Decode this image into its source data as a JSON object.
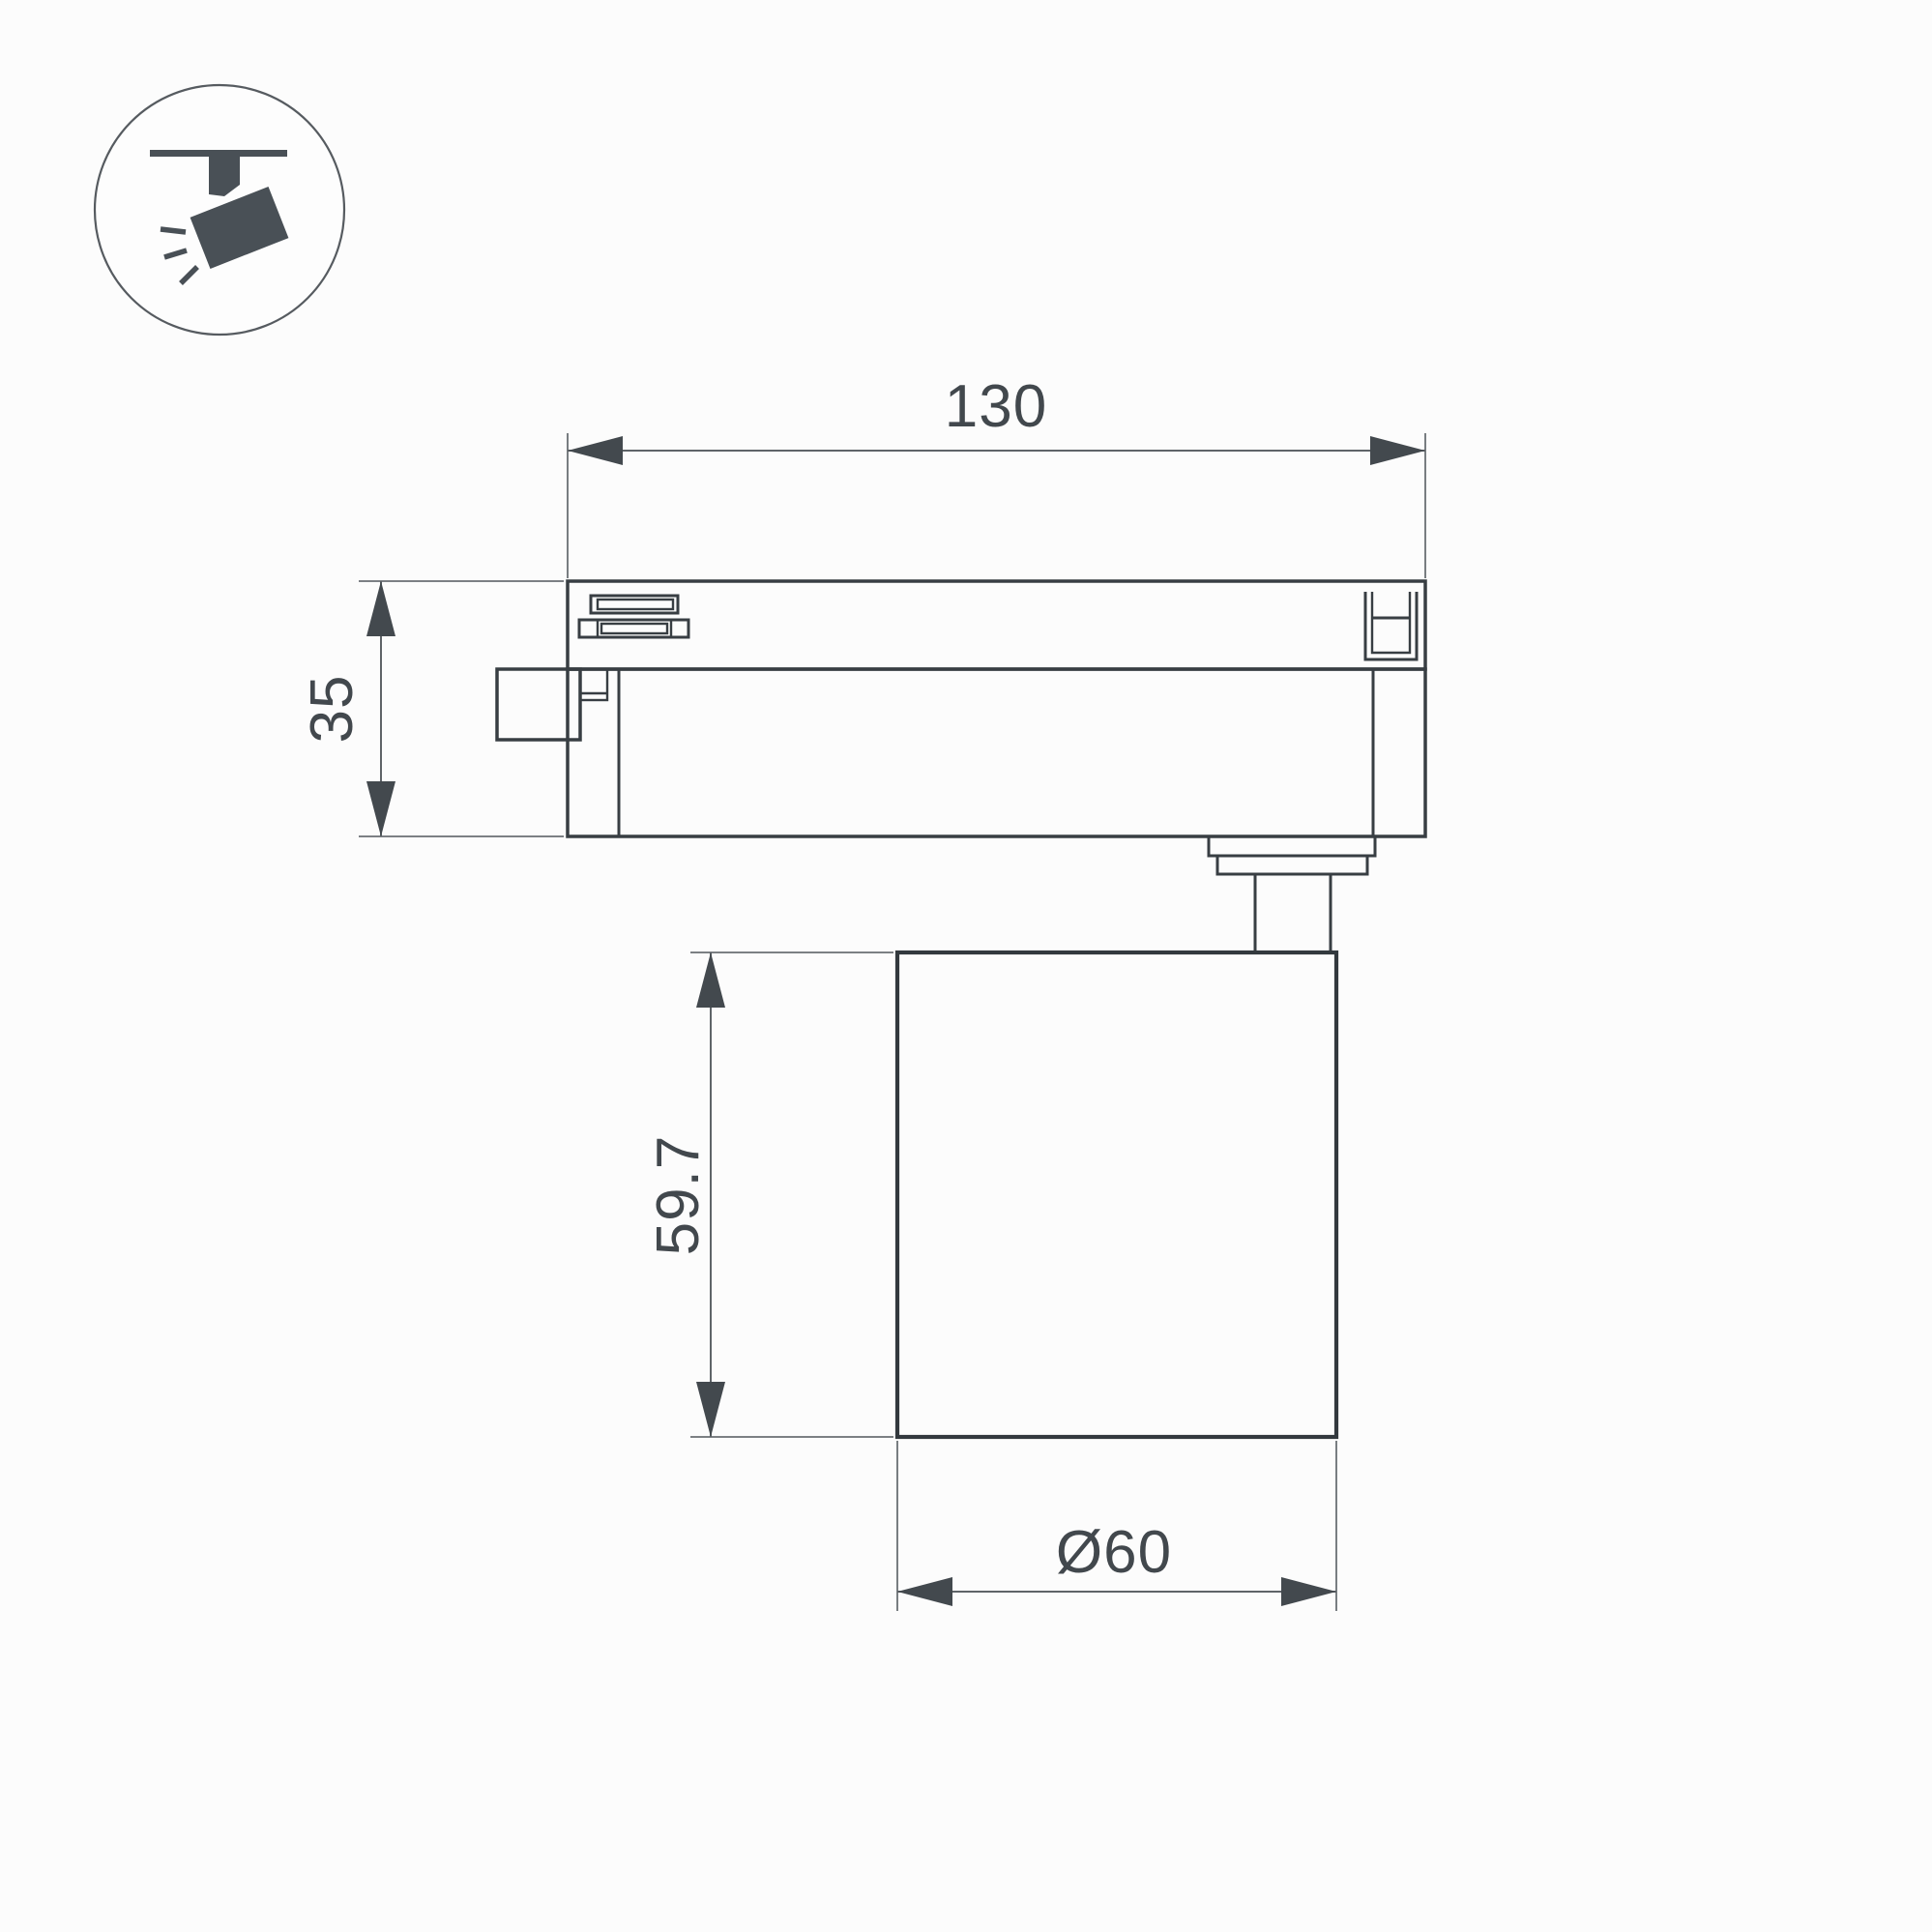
{
  "colors": {
    "background": "#fcfcfc",
    "outline": "#383e43",
    "dimension_line": "#5f6468",
    "dimension_text": "#42484d",
    "icon_fill": "#495056"
  },
  "icon": {
    "name": "track-spotlight-icon"
  },
  "dimensions": {
    "length": "130",
    "adapter_height": "35",
    "body_height": "59.7",
    "body_diameter": "Ø60"
  }
}
